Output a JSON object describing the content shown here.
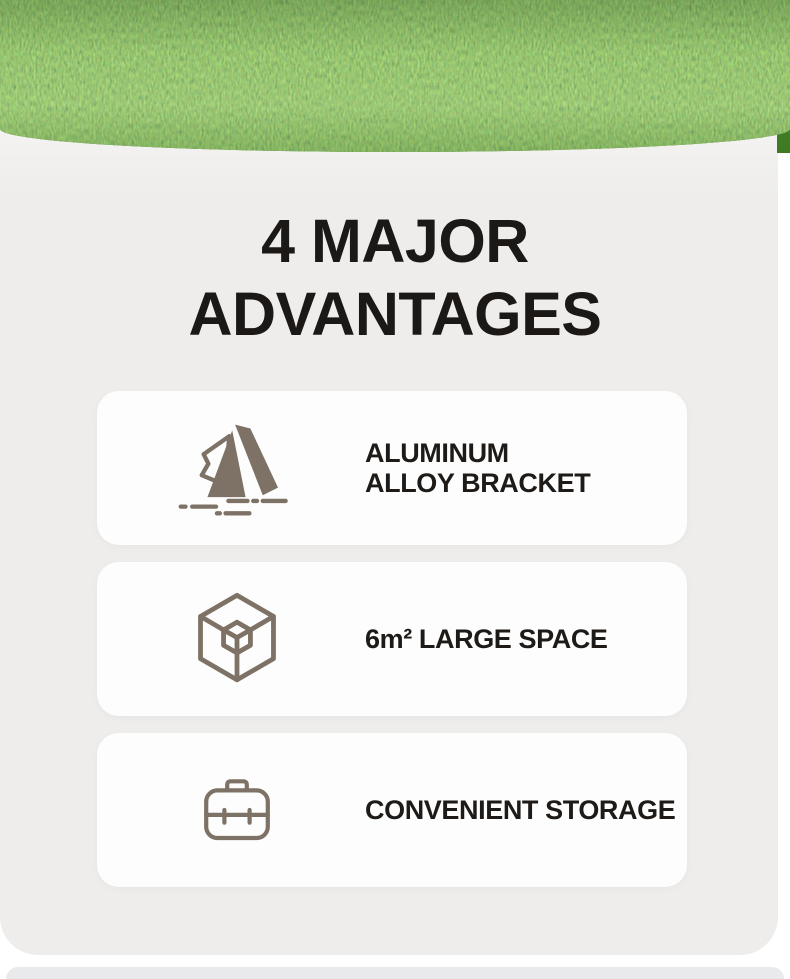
{
  "colors": {
    "panel-bg": "#eeedeb",
    "card-bg": "#fdfdfd",
    "title-color": "#1b1816",
    "text-color": "#1d1a17",
    "icon-color": "#7d7265",
    "strip-bg": "#e9eaec",
    "grass-dark": "#3e7a22",
    "grass-mid": "#4f8c29",
    "grass-light": "#67a338"
  },
  "hero": {
    "image": "grass-lawn-photo"
  },
  "header": {
    "title_line1": "4 MAJOR",
    "title_line2": "ADVANTAGES"
  },
  "advantages": [
    {
      "icon": "tent-icon",
      "lines": [
        "ALUMINUM",
        "ALLOY BRACKET"
      ]
    },
    {
      "icon": "cube-icon",
      "lines": [
        "6m² LARGE SPACE"
      ]
    },
    {
      "icon": "briefcase-icon",
      "lines": [
        "CONVENIENT STORAGE"
      ]
    }
  ]
}
